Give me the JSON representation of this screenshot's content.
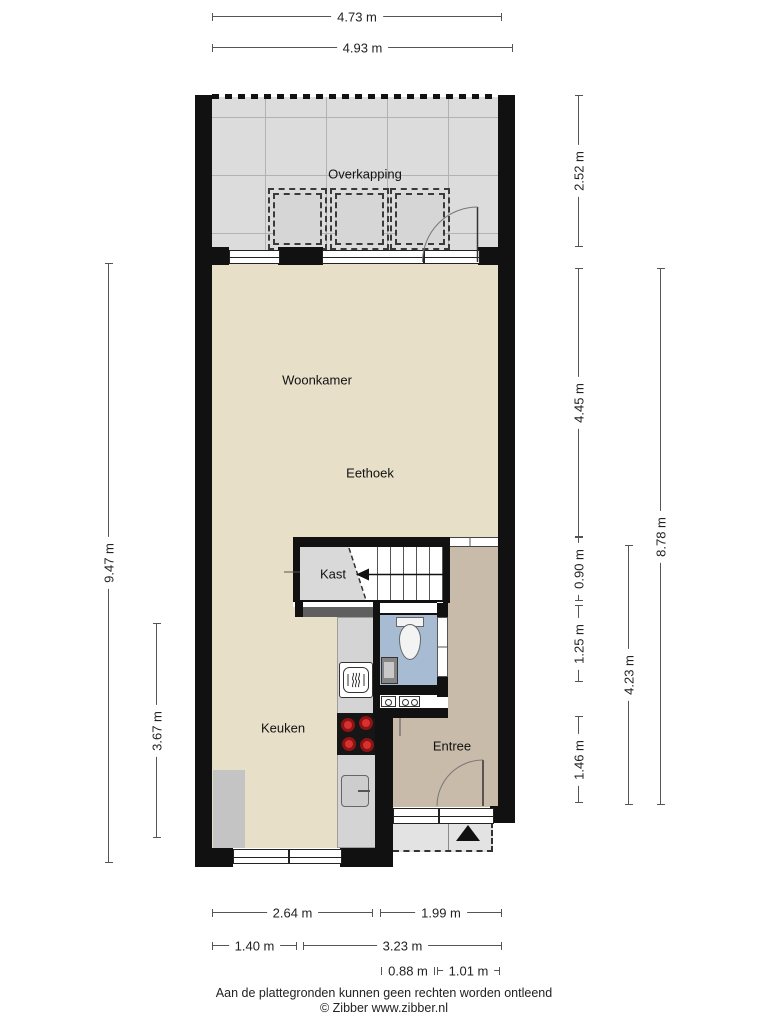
{
  "document": {
    "footer": {
      "disclaimer": "Aan de plattegronden kunnen geen rechten worden ontleend",
      "copyright": "© Zibber www.zibber.nl"
    }
  },
  "rooms": {
    "overkapping": {
      "label": "Overkapping"
    },
    "woonkamer": {
      "label": "Woonkamer"
    },
    "eethoek": {
      "label": "Eethoek"
    },
    "kast": {
      "label": "Kast"
    },
    "keuken": {
      "label": "Keuken"
    },
    "entree": {
      "label": "Entree"
    }
  },
  "dimensions": {
    "top": [
      "4.73 m",
      "4.93 m"
    ],
    "left": [
      "9.47 m",
      "3.67 m"
    ],
    "right": [
      "2.52 m",
      "4.45 m",
      "0.90 m",
      "1.25 m",
      "1.46 m",
      "4.23 m",
      "8.78 m"
    ],
    "bottom": [
      "2.64 m",
      "1.99 m",
      "1.40 m",
      "3.23 m",
      "0.88 m",
      "1.01 m"
    ]
  },
  "icons": [
    "toilet-icon",
    "hand-basin-icon",
    "oven-icon",
    "cooktop-icon",
    "kitchen-sink-icon",
    "stair-direction-arrow-icon",
    "entrance-arrow-icon",
    "door-swing-arc-icon",
    "north-entry-triangle"
  ],
  "colors": {
    "wall": "#111111",
    "floor_main": "#e7dfc8",
    "floor_entree": "#c9bbaa",
    "floor_toilet": "#a7bbd2",
    "floor_overkapping": "#dcdcdc",
    "floor_kast": "#d9d9d9",
    "counter": "#d4d4d4",
    "low_wall": "#5f5f5f",
    "porch": "#e3e3e3",
    "burner_red": "#c22525"
  }
}
